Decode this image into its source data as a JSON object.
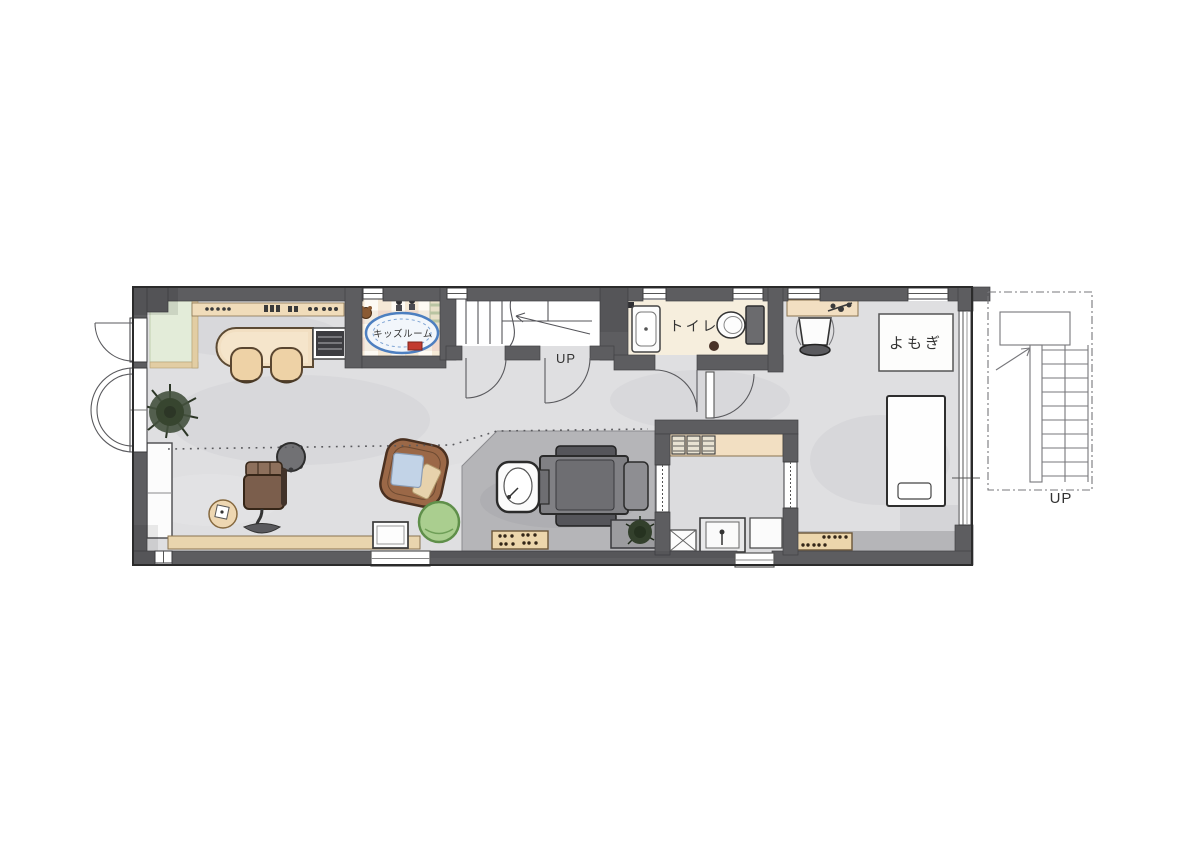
{
  "floorplan": {
    "type": "salon-residence-floor-plan",
    "labels": {
      "kids_room": "キッズルーム",
      "stairs_up": "UP",
      "toilet": "トイレ",
      "yomogi_sign": "よもぎ",
      "exterior_stairs_up": "UP"
    },
    "colors": {
      "wall": "#5d5d60",
      "floor_main": "#dfdfe1",
      "floor_doma": "#b5b5b8",
      "floor_toilet": "#f6eedd",
      "wood_beige": "#f2dfc2",
      "entry_green": "#e3ecd9",
      "rug_blue": "#4d7fc0",
      "pouf_green": "#aace8f",
      "sofa_brown": "#9b6847",
      "plant_green": "#44513e",
      "fixture_white": "#fcfcfc",
      "ink": "#2b2b2b"
    }
  }
}
